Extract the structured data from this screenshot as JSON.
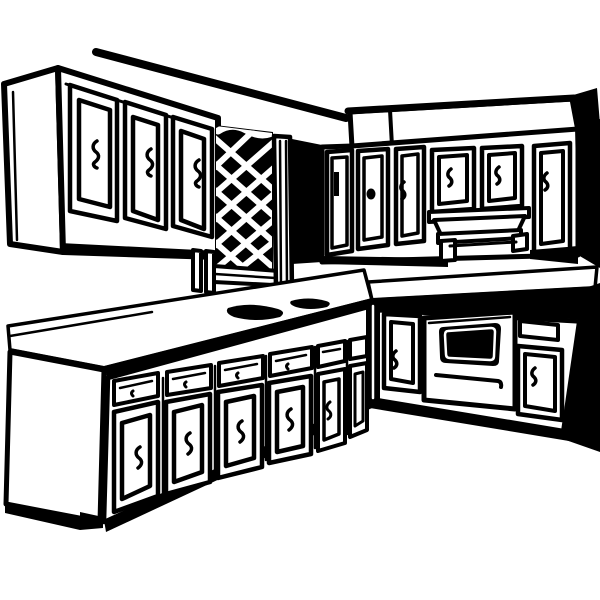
{
  "page": {
    "title": "Kitchen cabinets line-art illustration",
    "description": "Black-and-white retro clip-art drawing of an L-shaped kitchen: upper wall cabinets with squiggle handles, a dark diamond-lattice panel over the counter, right-wall upper cabinets with a range hood under a soffit, an L-shaped countertop with a dark sink shadow and cooktop burner squiggles, base cabinets with drawers and doors, a built-in oven with a black window and handle bar, black end panels and toe-kick."
  },
  "palette": {
    "ink": "#000000",
    "paper": "#ffffff"
  },
  "scene": {
    "parts": [
      {
        "name": "ceiling-line"
      },
      {
        "name": "upper-left-cabinet",
        "doors": 3
      },
      {
        "name": "lattice-panel"
      },
      {
        "name": "upper-right-cabinets",
        "doors": 6
      },
      {
        "name": "range-hood"
      },
      {
        "name": "soffit"
      },
      {
        "name": "countertop-left"
      },
      {
        "name": "sink-shadow"
      },
      {
        "name": "countertop-right"
      },
      {
        "name": "cooktop-burners"
      },
      {
        "name": "base-cabinets-left",
        "units": 6
      },
      {
        "name": "base-cabinets-right"
      },
      {
        "name": "oven"
      },
      {
        "name": "toe-kick"
      }
    ]
  }
}
